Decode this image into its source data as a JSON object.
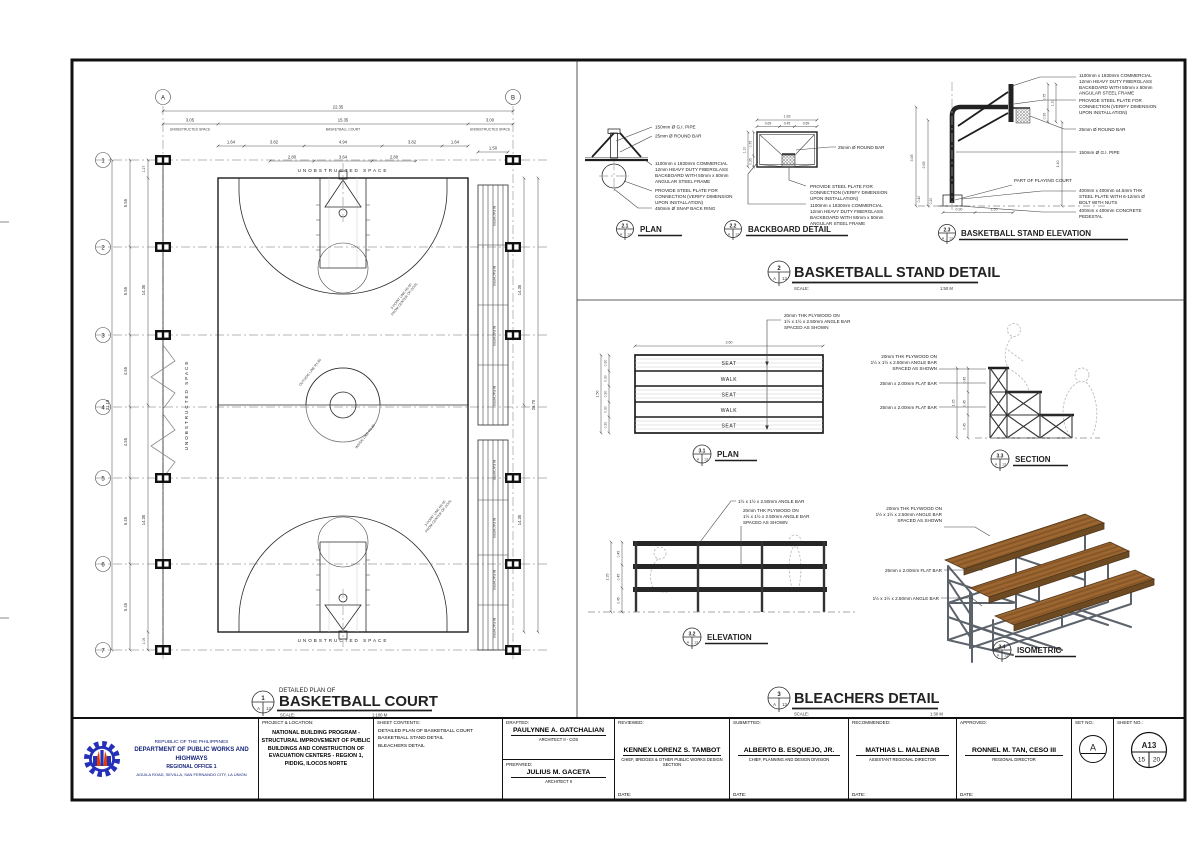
{
  "ref": {
    "set": "A",
    "sheet": "13"
  },
  "colors": {
    "line": "#1d1d1d",
    "wood": "#95612d",
    "wood_dark": "#6e4a22",
    "steel": "#5d636b",
    "logo_blue": "#2430b8",
    "logo_red": "#e23c00"
  },
  "court": {
    "cols": [
      "A",
      "B"
    ],
    "rows": [
      "1",
      "2",
      "3",
      "4",
      "5",
      "6",
      "7"
    ],
    "dims": {
      "overall_w": "22.35",
      "margin_left": "3.05",
      "court_w": "15.35",
      "margin_right": "3.00",
      "sub_w": [
        "1.64",
        "3.82",
        "4.94",
        "3.82",
        "1.64"
      ],
      "key_w": [
        "2.80",
        "3.64",
        "2.80"
      ],
      "bleacher_w": "1.50",
      "row_h": [
        "5.55",
        "5.55",
        "4.55",
        "4.55",
        "5.45",
        "5.45"
      ],
      "overall_h": "31.10",
      "inner_top": "1.27",
      "inner_bottom": "1.05",
      "court_groups": [
        "14.35",
        "14.35"
      ],
      "right_groups": [
        "14.35",
        "14.35"
      ],
      "court_h": "28.70"
    },
    "labels": {
      "unobstructed": "UNOBSTRUCTED SPACE",
      "basketball_court": "BASKETBALL COURT",
      "bleachers": "BLEACHERS",
      "center_circle": "OUTSIDE LINE R1.80",
      "inside_circle": "INSIDE LINE R1.80",
      "three_point": [
        "3-POINT LINE R6.60",
        "FROM CENTER OF GOAL"
      ]
    },
    "header": {
      "no": "1",
      "pre": "DETAILED PLAN OF",
      "title": "BASKETBALL COURT",
      "scale_label": "SCALE:",
      "scale": "1:100 M"
    }
  },
  "stand": {
    "header": {
      "no": "2",
      "title": "BASKETBALL STAND DETAIL",
      "scale_label": "SCALE:",
      "scale": "1:50 M"
    },
    "common": {
      "backboard_spec": [
        "1100mm x 1830mm COMMERCIAL",
        "12mm HEAVY DUTY FIBERGLASS",
        "BACKBOARD WITH 50mm x 50mm",
        "ANGULAR STEEL FRAME"
      ],
      "steel_plate_note": [
        "PROVIDE STEEL PLATE FOR",
        "CONNECTION (VERIFY DIMENSION",
        "UPON INSTALLATION)"
      ],
      "round_bar": "25mm Ø ROUND BAR",
      "gi_pipe": "150mm Ø G.I. PIPE"
    },
    "plan": {
      "no": "2.1",
      "title": "PLAN",
      "ann_snap_ring": "450mm Ø SNAP BACK RING"
    },
    "backboard": {
      "no": "2.2",
      "title": "BACKBOARD DETAIL",
      "dim_w": "1.83",
      "dim_w_parts": [
        "0.69",
        "0.45",
        "0.69"
      ],
      "dim_h": "1.10",
      "dim_h_parts": [
        "0.75",
        "0.35"
      ]
    },
    "elevation": {
      "no": "2.3",
      "title": "BASKETBALL STAND ELEVATION",
      "ann_court": "PART OF PLAYING COURT",
      "ann_plate": [
        "400mm x 400mm x4.5mm THK",
        "STEEL PLATE WITH 6-12mm Ø",
        "BOLT WITH NUTS"
      ],
      "ann_pedestal": [
        "400mm x 400mm CONCRETE",
        "PEDESTAL"
      ],
      "dims": {
        "pole_h": "3.05",
        "ring_h": "2.65",
        "ped_h": "0.40",
        "plate": "0.20",
        "base_w": "0.90",
        "overhang": "1.20",
        "board_off": "1.40",
        "bb_upper": "0.75",
        "bb_h": "1.10",
        "bb_lower": "0.35"
      }
    }
  },
  "bleachers": {
    "header": {
      "no": "3",
      "title": "BLEACHERS DETAIL",
      "scale_label": "SCALE:",
      "scale": "1:30 M"
    },
    "common": {
      "plywood_note": [
        "20mm THK PLYWOOD ON",
        "1½ x 1½ x 2.50mm ANGLE BAR",
        "SPACED AS SHOWN"
      ],
      "angle_bar": "1½ x 1½ x 2.50mm ANGLE BAR",
      "flat_bar": "25mm x 2.00mm FLAT BAR"
    },
    "plan": {
      "no": "3.1",
      "title": "PLAN",
      "rows": [
        "SEAT",
        "WALK",
        "SEAT",
        "WALK",
        "SEAT"
      ],
      "dim_w": "3.60",
      "dim_h": "1.50",
      "row_dims": [
        "0.30",
        "0.30",
        "0.30",
        "0.30",
        "0.30"
      ]
    },
    "elevation": {
      "no": "3.2",
      "title": "ELEVATION",
      "dim_total": "1.35",
      "step_dims": [
        "0.45",
        "0.45",
        "0.45"
      ]
    },
    "section": {
      "no": "3.3",
      "title": "SECTION",
      "dim_total": "1.35",
      "step_dims": [
        "0.45",
        "0.45",
        "0.45"
      ]
    },
    "isometric": {
      "no": "3.4",
      "title": "ISOMETRIC"
    }
  },
  "title_block": {
    "agency": {
      "line1": "REPUBLIC OF THE PHILIPPINES",
      "line2": "DEPARTMENT OF PUBLIC WORKS AND HIGHWAYS",
      "line3": "REGIONAL OFFICE 1",
      "line4": "AGUILA ROAD, SEVILLA, SAN FERNANDO CITY, LA UNION"
    },
    "project": {
      "label": "PROJECT & LOCATION:",
      "lines": [
        "NATIONAL BUILDING PROGRAM -",
        "STRUCTURAL IMPROVEMENT OF PUBLIC",
        "BUILDINGS AND CONSTRUCTION OF",
        "EVACUATION CENTERS - REGION 1,",
        "PIDDIG, ILOCOS NORTE"
      ]
    },
    "sheet_contents": {
      "label": "SHEET CONTENTS:",
      "lines": [
        "DETAILED PLAN OF BASKETBALL COURT",
        "BASKETBALL STAND DETAIL",
        "BLEACHERS DETAIL"
      ]
    },
    "drafted": {
      "label": "DRAFTED:",
      "name": "PAULYNNE A. GATCHALIAN",
      "title": "ARCHITECT II - COS"
    },
    "prepared": {
      "label": "PREPARED:",
      "name": "JULIUS M. GACETA",
      "title": "ARCHITECT II"
    },
    "reviewed": {
      "label": "REVIEWED:",
      "name": "KENNEX LORENZ S. TAMBOT",
      "title": "CHIEF, BRIDGES & OTHER PUBLIC WORKS DESIGN SECTION",
      "date_label": "DATE:"
    },
    "submitted": {
      "label": "SUBMITTED:",
      "name": "ALBERTO B. ESQUEJO, JR.",
      "title": "CHIEF, PLANNING AND DESIGN DIVISION",
      "date_label": "DATE:"
    },
    "recommended": {
      "label": "RECOMMENDED:",
      "name": "MATHIAS L. MALENAB",
      "title": "ASSISTANT REGIONAL DIRECTOR",
      "date_label": "DATE:"
    },
    "approved": {
      "label": "APPROVED:",
      "name": "RONNEL M. TAN, CESO III",
      "title": "REGIONAL DIRECTOR",
      "date_label": "DATE:"
    },
    "set_no": {
      "label": "SET NO.:",
      "value": "A"
    },
    "sheet_no": {
      "label": "SHEET NO.:",
      "value": "A13",
      "page": "15",
      "total": "20"
    }
  }
}
